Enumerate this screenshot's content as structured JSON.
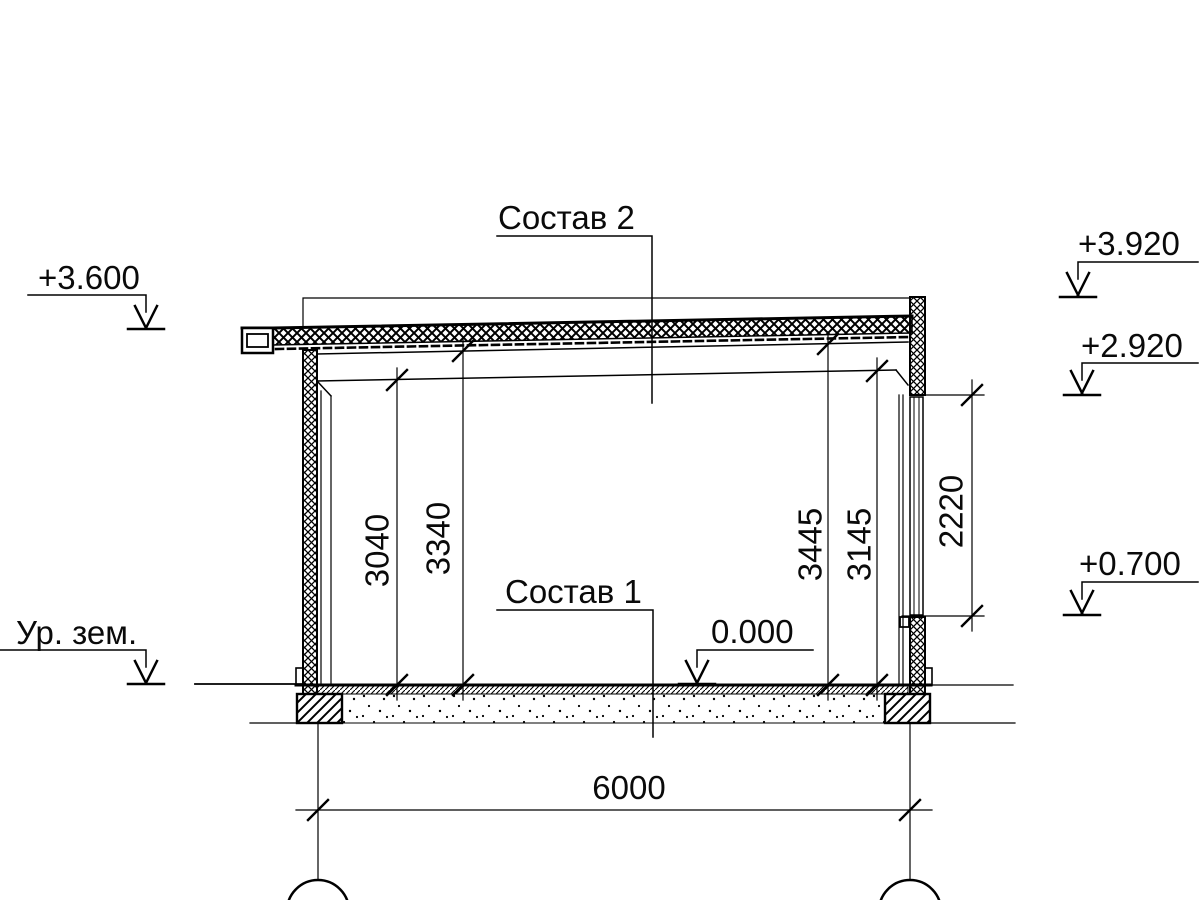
{
  "drawing": {
    "type": "building-section",
    "labels": {
      "composition_roof": "Состав 2",
      "composition_floor": "Состав 1",
      "ground_level": "Ур. зем."
    },
    "elevations": {
      "eave_left": "+3.600",
      "wall_top_right": "+3.920",
      "window_head": "+2.920",
      "window_sill": "+0.700",
      "floor": "0.000"
    },
    "dimensions": {
      "clear_height_left": "3040",
      "roof_underside_left": "3340",
      "roof_underside_right": "3445",
      "clear_height_right": "3145",
      "window_height": "2220",
      "span": "6000"
    },
    "colors": {
      "line": "#000000",
      "background": "#ffffff"
    }
  }
}
